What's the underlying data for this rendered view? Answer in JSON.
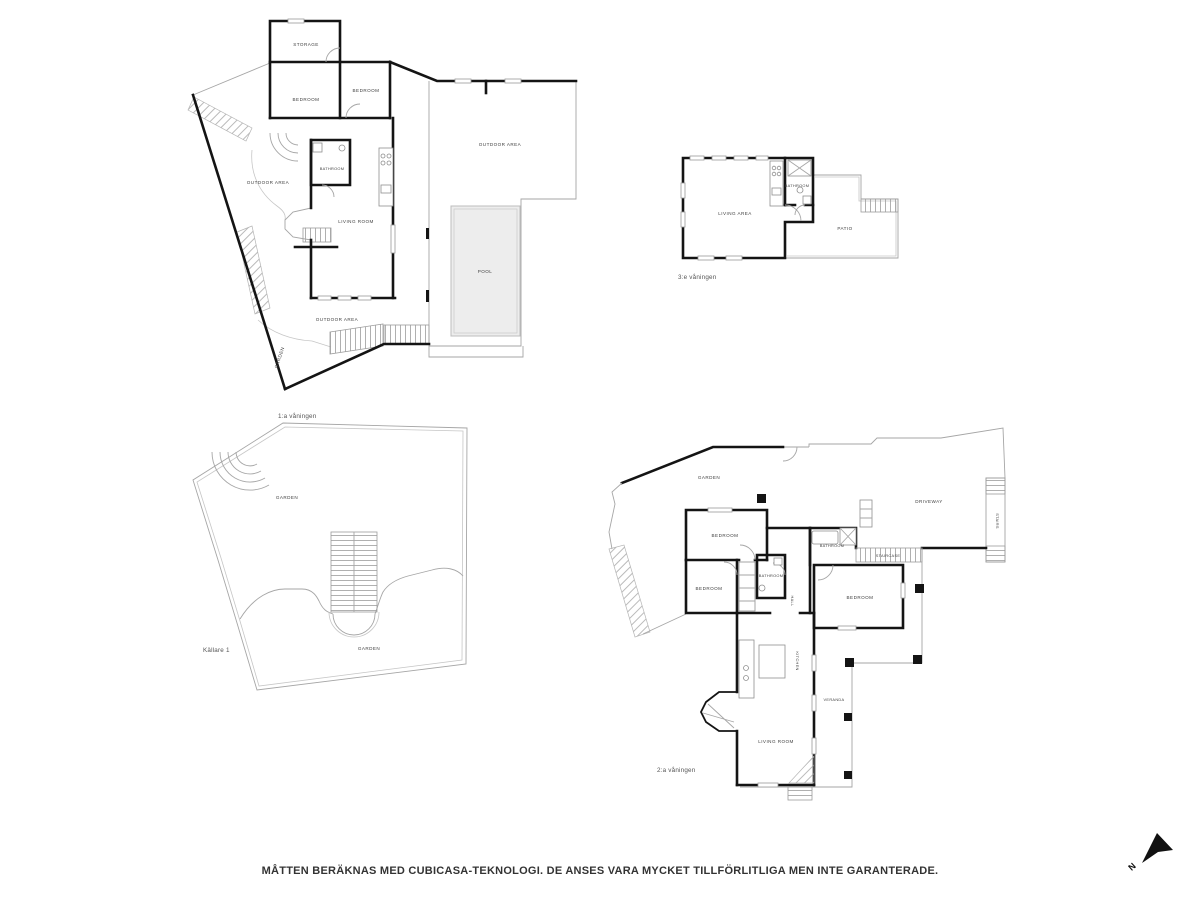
{
  "document": {
    "disclaimer": "MÅTTEN BERÄKNAS MED CUBICASA-TEKNOLOGI. DE ANSES VARA MYCKET TILLFÖRLITLIGA MEN INTE GARANTERADE.",
    "compass_label": "N"
  },
  "colors": {
    "wall": "#141414",
    "thin_line": "#a6a6a6",
    "pool_fill": "#ededed",
    "label_text": "#3f3f3f",
    "background": "#ffffff"
  },
  "plans": {
    "floor1": {
      "floor_label": "1:a våningen",
      "rooms": {
        "storage": "STORAGE",
        "bedroom_a": "BEDROOM",
        "bedroom_b": "BEDROOM",
        "bathroom": "BATHROOM",
        "outdoor_area_west": "OUTDOOR AREA",
        "living_room": "LIVING ROOM",
        "outdoor_area_northeast": "OUTDOOR AREA",
        "pool": "POOL",
        "outdoor_area_south": "OUTDOOR AREA",
        "garden": "GARDEN"
      }
    },
    "floor3": {
      "floor_label": "3:e våningen",
      "rooms": {
        "living_area": "LIVING AREA",
        "bathroom": "BATHROOM",
        "patio": "PATIO"
      }
    },
    "basement": {
      "floor_label": "Källare 1",
      "rooms": {
        "garden_upper": "GARDEN",
        "garden_lower": "GARDEN"
      }
    },
    "floor2": {
      "floor_label": "2:a våningen",
      "rooms": {
        "garden": "GARDEN",
        "driveway": "DRIVEWAY",
        "stairs": "STAIRS",
        "staircase": "STAIRCASE",
        "bedroom_a": "BEDROOM",
        "bedroom_b": "BEDROOM",
        "bedroom_c": "BEDROOM",
        "bathroom_a": "BATHROOM",
        "bathroom_b": "BATHROOM",
        "hall": "HALL",
        "kitchen": "KITCHEN",
        "living_room": "LIVING ROOM",
        "veranda": "VERANDA"
      }
    }
  }
}
